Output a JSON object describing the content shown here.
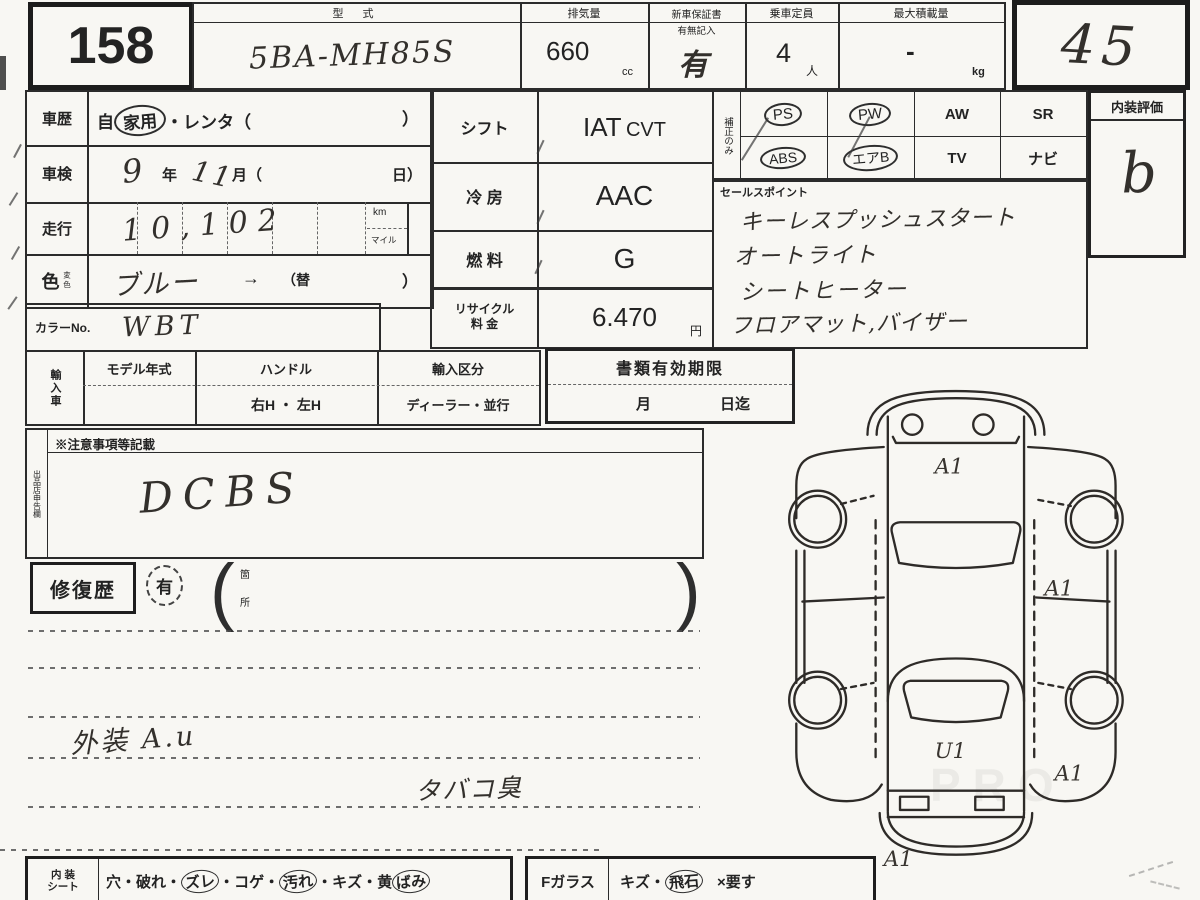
{
  "colors": {
    "paper": "#f8f7f3",
    "ink": "#2b2b2b",
    "handwriting": "#33302c"
  },
  "lot": {
    "number": "158"
  },
  "grade": {
    "value": "45"
  },
  "header": {
    "model_label": "型  式",
    "model_value": "5BA-MH85S",
    "disp_label": "排気量",
    "disp_value": "660",
    "disp_unit": "cc",
    "warranty_label": "新車保証書",
    "warranty_sub": "有無記入",
    "warranty_value": "有",
    "capacity_label": "乗車定員",
    "capacity_value": "4",
    "capacity_unit": "人",
    "payload_label": "最大積載量",
    "payload_value": "-",
    "payload_unit": "kg"
  },
  "history": {
    "label": "車歴",
    "pre": "自",
    "circled_part": "家用",
    "post": "・レンタ（",
    "close": "）"
  },
  "inspection": {
    "label": "車検",
    "year": "9",
    "year_unit": "年",
    "month": "11",
    "month_unit": "月（",
    "day_unit": "日）"
  },
  "mileage": {
    "label": "走行",
    "value": "10,102",
    "unit_km": "km",
    "unit_mile": "マイル"
  },
  "color": {
    "label": "色",
    "label_sub": "変色",
    "value": "ブルー",
    "arrow": "→",
    "change_open": "（替",
    "close": "）"
  },
  "color_no": {
    "label": "カラーNo.",
    "value": "WBT"
  },
  "specs": {
    "shift_label": "シフト",
    "shift_value_1": "IAT",
    "shift_value_2": "CVT",
    "ac_label": "冷 房",
    "ac_value": "AAC",
    "fuel_label": "燃 料",
    "fuel_value": "G",
    "recycle_label_1": "リサイクル",
    "recycle_label_2": "料 金",
    "recycle_value": "6.470",
    "recycle_unit": "円"
  },
  "equipment": {
    "side_label": "補正のみ",
    "items": [
      {
        "label": "PS",
        "circled": true
      },
      {
        "label": "PW",
        "circled": true
      },
      {
        "label": "AW",
        "circled": false
      },
      {
        "label": "SR",
        "circled": false
      },
      {
        "label": "ABS",
        "circled": true
      },
      {
        "label": "エアB",
        "circled": true
      },
      {
        "label": "TV",
        "circled": false
      },
      {
        "label": "ナビ",
        "circled": false
      }
    ]
  },
  "sales_points": {
    "label": "セールスポイント",
    "lines": [
      "キーレスプッシュスタート",
      "オートライト",
      "シートヒーター",
      "フロアマット,バイザー"
    ]
  },
  "interior_grade": {
    "label": "内装評価",
    "value": "b"
  },
  "import_section": {
    "side_label": "輸入車",
    "model_year_label": "モデル年式",
    "handle_label": "ハンドル",
    "handle_value": "右H ・ 左H",
    "type_label": "輸入区分",
    "type_value": "ディーラー・並行"
  },
  "documents": {
    "label": "書類有効期限",
    "month_label": "月",
    "day_label": "日迄"
  },
  "notes": {
    "side_label": "出品店申告欄",
    "label": "※注意事項等記載",
    "value": "DCBS"
  },
  "repair": {
    "label": "修復歴",
    "value": "有",
    "paren_open": "(",
    "paren_close": ")",
    "spot_top": "箇",
    "spot_bottom": "所"
  },
  "memo": {
    "line1": "外装 A.u",
    "line2": "タバコ臭"
  },
  "interior_seat": {
    "label_1": "内 装",
    "label_2": "シート",
    "sep": "・",
    "items": [
      {
        "text": "穴",
        "circled": false
      },
      {
        "text": "破れ",
        "circled": false
      },
      {
        "text": "ズレ",
        "circled": true
      },
      {
        "text": "コゲ",
        "circled": false
      },
      {
        "text": "汚れ",
        "circled": true
      },
      {
        "text": "キズ",
        "circled": false
      },
      {
        "text": "黄",
        "circled": false
      },
      {
        "text": "ばみ",
        "circled": true
      }
    ]
  },
  "f_glass": {
    "label": "Fガラス",
    "sep": "・",
    "items": [
      {
        "text": "キズ",
        "circled": false
      },
      {
        "text": "飛石",
        "circled": true
      },
      {
        "text": "×要す",
        "circled": false
      }
    ]
  },
  "diagram": {
    "hood": "A1",
    "side_right": "A1",
    "trunk": "U1",
    "quarter_right": "A1",
    "rear": "A1"
  },
  "watermark": {
    "text": "PRO"
  }
}
